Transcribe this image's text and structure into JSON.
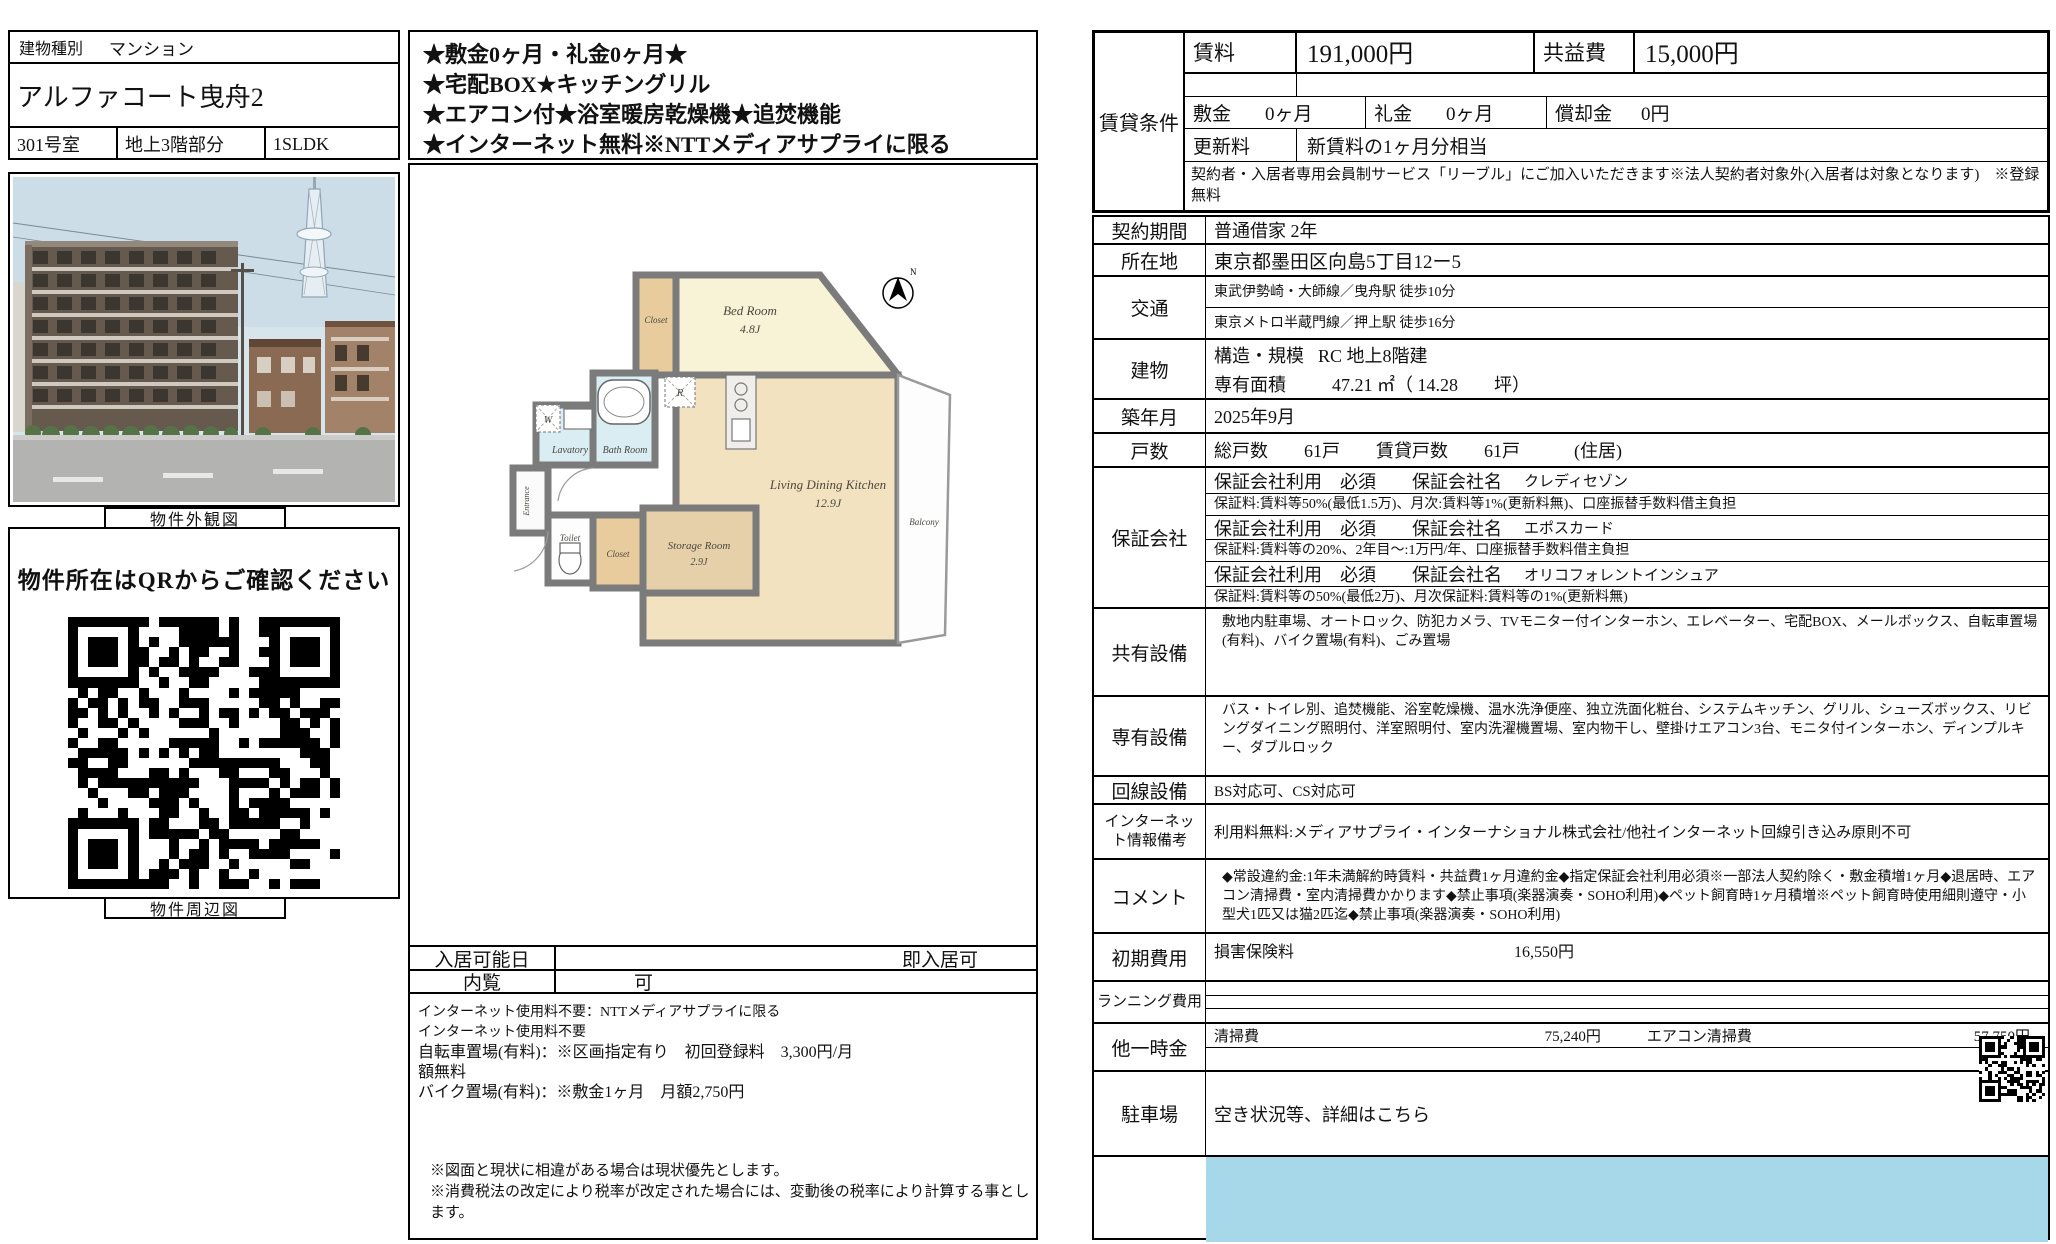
{
  "left": {
    "building_type_label": "建物種別",
    "building_type": "マンション",
    "building_name": "アルファコート曳舟2",
    "room_no": "301号室",
    "floor_part": "地上3階部分",
    "layout": "1SLDK",
    "photo_caption": "物件外観図",
    "qr_heading": "物件所在はQRからご確認ください",
    "map_caption": "物件周辺図"
  },
  "center": {
    "highlights": [
      "★敷金0ヶ月・礼金0ヶ月★",
      "★宅配BOX★キッチングリル",
      "★エアコン付★浴室暖房乾燥機★追焚機能",
      "★インターネット無料※NTTメディアサプライに限る"
    ],
    "floorplan": {
      "bedroom": "Bed Room",
      "bedroom_size": "4.8J",
      "closet1": "Closet",
      "closet2": "Closet",
      "lavatory": "Lavatory",
      "bathroom": "Bath Room",
      "toilet": "Toilet",
      "entrance": "Entrance",
      "storage": "Storage Room",
      "storage_size": "2.9J",
      "ldk": "Living Dining Kitchen",
      "ldk_size": "12.9J",
      "balcony": "Balcony",
      "washer": "W",
      "fridge": "R",
      "north": "N"
    },
    "move_in_label": "入居可能日",
    "move_in_value": "即入居可",
    "viewing_label": "内覧",
    "viewing_value": "可",
    "notes": [
      "インターネット使用料不要：NTTメディアサプライに限る",
      "インターネット使用料不要",
      "自転車置場(有料)：※区画指定有り　初回登録料　3,300円/月",
      "額無料",
      "バイク置場(有料)：※敷金1ヶ月　月額2,750円"
    ],
    "footer_notes": [
      "※図面と現状に相違がある場合は現状優先とします。",
      "※消費税法の改定により税率が改定された場合には、変動後の税率により計算する事とします。"
    ]
  },
  "rent": {
    "section_label": "賃貸条件",
    "rent_label": "賃料",
    "rent_value": "191,000円",
    "fee_label": "共益費",
    "fee_value": "15,000円",
    "deposit_label": "敷金",
    "deposit_value": "0ヶ月",
    "key_label": "礼金",
    "key_value": "0ヶ月",
    "amort_label": "償却金",
    "amort_value": "0円",
    "renewal_label": "更新料",
    "renewal_value": "新賃料の1ヶ月分相当",
    "membership_note": "契約者・入居者専用会員制サービス「リーブル」にご加入いただきます※法人契約者対象外(入居者は対象となります)　※登録無料"
  },
  "details": {
    "contract": {
      "label": "契約期間",
      "value": "普通借家 2年"
    },
    "address": {
      "label": "所在地",
      "value": "東京都墨田区向島5丁目12ー5"
    },
    "access": {
      "label": "交通",
      "lines": [
        "東武伊勢崎・大師線／曳舟駅 徒歩10分",
        "東京メトロ半蔵門線／押上駅 徒歩16分"
      ]
    },
    "building": {
      "label": "建物",
      "structure_label": "構造・規模",
      "structure": "RC 地上8階建",
      "area_label": "専有面積",
      "area": "47.21 ㎡（ 14.28　　坪）"
    },
    "built": {
      "label": "築年月",
      "value": "2025年9月"
    },
    "units": {
      "label": "戸数",
      "value": "総戸数　　61戸　　賃貸戸数　　61戸　　　(住居)"
    },
    "guarantors": {
      "label": "保証会社",
      "items": [
        {
          "head": "保証会社利用　必須　　保証会社名",
          "name": "クレディセゾン",
          "detail": "保証料:賃料等50%(最低1.5万)、月次:賃料等1%(更新料無)、口座振替手数料借主負担"
        },
        {
          "head": "保証会社利用　必須　　保証会社名",
          "name": "エポスカード",
          "detail": "保証料:賃料等の20%、2年目～:1万円/年、口座振替手数料借主負担"
        },
        {
          "head": "保証会社利用　必須　　保証会社名",
          "name": "オリコフォレントインシュア",
          "detail": "保証料:賃料等の50%(最低2万)、月次保証料:賃料等の1%(更新料無)"
        }
      ]
    },
    "common_fac": {
      "label": "共有設備",
      "value": "敷地内駐車場、オートロック、防犯カメラ、TVモニター付インターホン、エレベーター、宅配BOX、メールボックス、自転車置場(有料)、バイク置場(有料)、ごみ置場"
    },
    "private_fac": {
      "label": "専有設備",
      "value": "バス・トイレ別、追焚機能、浴室乾燥機、温水洗浄便座、独立洗面化粧台、システムキッチン、グリル、シューズボックス、リビングダイニング照明付、洋室照明付、室内洗濯機置場、室内物干し、壁掛けエアコン3台、モニタ付インターホン、ディンプルキー、ダブルロック"
    },
    "line_fac": {
      "label": "回線設備",
      "value": "BS対応可、CS対応可"
    },
    "internet": {
      "label": "インターネット情報備考",
      "value": "利用料無料:メディアサプライ・インターナショナル株式会社/他社インターネット回線引き込み原則不可"
    },
    "comment": {
      "label": "コメント",
      "value": "◆常設違約金:1年未満解約時賃料・共益費1ヶ月違約金◆指定保証会社利用必須※一部法人契約除く・敷金積増1ヶ月◆退居時、エアコン清掃費・室内清掃費かかります◆禁止事項(楽器演奏・SOHO利用)◆ペット飼育時1ヶ月積増※ペット飼育時使用細則遵守・小型犬1匹又は猫2匹迄◆禁止事項(楽器演奏・SOHO利用)"
    },
    "initial": {
      "label": "初期費用",
      "item": "損害保険料",
      "value": "16,550円"
    },
    "running": {
      "label": "ランニング費用"
    },
    "other": {
      "label": "他一時金",
      "item1": "清掃費",
      "value1": "75,240円",
      "item2": "エアコン清掃費",
      "value2": "57,750円"
    },
    "parking": {
      "label": "駐車場",
      "value": "空き状況等、詳細はこちら"
    }
  },
  "colors": {
    "bottom_bar": "#a7d8e9"
  }
}
